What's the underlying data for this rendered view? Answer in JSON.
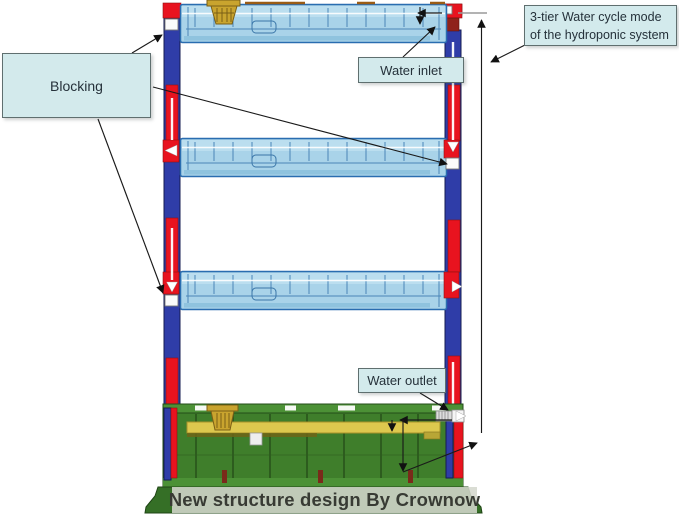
{
  "note": {
    "line1": "3-tier Water cycle mode",
    "line2": "of the hydroponic system"
  },
  "callouts": {
    "blocking": "Blocking",
    "water_inlet": "Water inlet",
    "water_outlet": "Water outlet"
  },
  "banner": {
    "text": "New structure design By Crownow"
  },
  "diagram": {
    "tier_count": 3,
    "parts": [
      "grow tray",
      "net pot",
      "riser column",
      "water pipe",
      "blocking plug",
      "water inlet elbow",
      "water outlet connector",
      "nutrient tank",
      "support bar"
    ]
  },
  "colors": {
    "label_bg": "#d3eaec",
    "label_border": "#5f6f6f",
    "label_text": "#25313a",
    "tray_fill": "#a9d3e9",
    "tray_stroke": "#2a6db0",
    "column_blue": "#2f3da8",
    "pipe_red": "#e8131f",
    "pipe_dark_red": "#8f221b",
    "tank_green": "#3f7e2b",
    "tank_dark": "#2d5c1e",
    "tank_light": "#4c9136",
    "bar_yellow": "#ddc84e",
    "basket_gold": "#c9a42e",
    "banner_bg": "rgba(213,216,206,0.87)",
    "banner_text": "#383b34",
    "arrow": "#1a1a1a"
  }
}
